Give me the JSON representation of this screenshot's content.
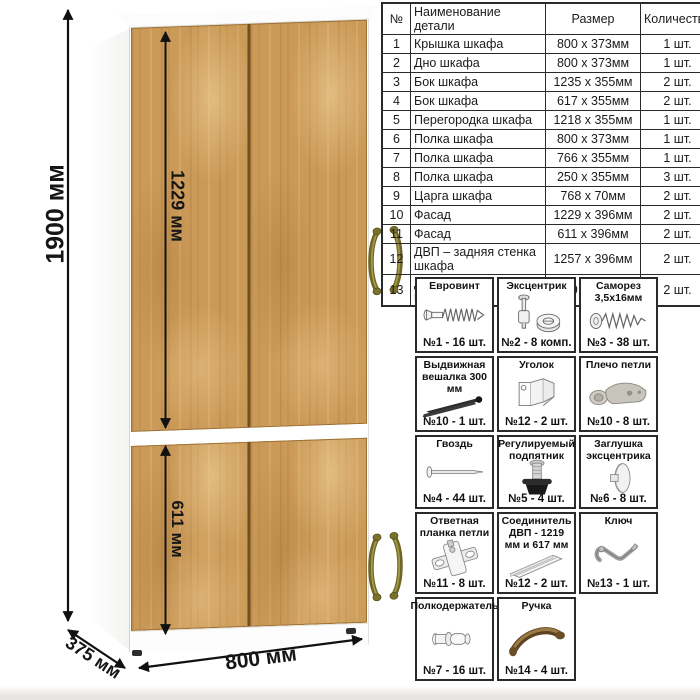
{
  "dimensions": {
    "height_label": "1900 мм",
    "upper_door_label": "1229 мм",
    "lower_door_label": "611 мм",
    "width_label": "800 мм",
    "depth_label": "375 мм"
  },
  "parts_table": {
    "headers": {
      "num": "№",
      "name": "Наименование детали",
      "size": "Размер",
      "qty": "Количество"
    },
    "rows": [
      {
        "num": "1",
        "name": "Крышка шкафа",
        "size": "800 x 373мм",
        "qty": "1 шт."
      },
      {
        "num": "2",
        "name": "Дно шкафа",
        "size": "800 x 373мм",
        "qty": "1 шт."
      },
      {
        "num": "3",
        "name": "Бок шкафа",
        "size": "1235 x 355мм",
        "qty": "2 шт."
      },
      {
        "num": "4",
        "name": "Бок шкафа",
        "size": "617 x 355мм",
        "qty": "2 шт."
      },
      {
        "num": "5",
        "name": "Перегородка шкафа",
        "size": "1218 x 355мм",
        "qty": "1 шт."
      },
      {
        "num": "6",
        "name": "Полка шкафа",
        "size": "800 x 373мм",
        "qty": "1 шт."
      },
      {
        "num": "7",
        "name": "Полка шкафа",
        "size": "766 x 355мм",
        "qty": "1 шт."
      },
      {
        "num": "8",
        "name": "Полка шкафа",
        "size": "250 x 355мм",
        "qty": "3 шт."
      },
      {
        "num": "9",
        "name": "Царга шкафа",
        "size": "768 x 70мм",
        "qty": "2 шт."
      },
      {
        "num": "10",
        "name": "Фасад",
        "size": "1229 x 396мм",
        "qty": "2 шт."
      },
      {
        "num": "11",
        "name": "Фасад",
        "size": "611 x 396мм",
        "qty": "2 шт."
      },
      {
        "num": "12",
        "name": "ДВП – задняя стенка шкафа",
        "size": "1257 x 396мм",
        "qty": "2 шт."
      },
      {
        "num": "13",
        "name": "ДВП – задняя стенка шкафа",
        "size": "639 x 396мм",
        "qty": "2 шт."
      }
    ]
  },
  "hardware": {
    "items": [
      {
        "title": "Евровинт",
        "label": "№1 - 16 шт.",
        "icon": "confirmat-screw"
      },
      {
        "title": "Эксцентрик",
        "label": "№2 - 8 комп.",
        "icon": "eccentric-cam"
      },
      {
        "title": "Саморез 3,5х16мм",
        "label": "№3 - 38 шт.",
        "icon": "self-tapping-screw"
      },
      {
        "title": "Выдвижная вешалка 300 мм",
        "label": "№10 - 1 шт.",
        "icon": "pullout-hanger"
      },
      {
        "title": "Уголок",
        "label": "№12 - 2 шт.",
        "icon": "corner-bracket"
      },
      {
        "title": "Плечо петли",
        "label": "№10 - 8 шт.",
        "icon": "hinge-arm"
      },
      {
        "title": "Гвоздь",
        "label": "№4 - 44 шт.",
        "icon": "nail"
      },
      {
        "title": "Регулируемый подпятник",
        "label": "№5 - 4 шт.",
        "icon": "adjustable-foot"
      },
      {
        "title": "Заглушка эксцентрика",
        "label": "№6 - 8 шт.",
        "icon": "cam-cover"
      },
      {
        "title": "Ответная планка петли",
        "label": "№11 - 8 шт.",
        "icon": "hinge-mounting-plate"
      },
      {
        "title": "Соединитель ДВП - 1219 мм и 617 мм",
        "label": "№12 - 2 шт.",
        "icon": "hdf-connector"
      },
      {
        "title": "Ключ",
        "label": "№13 - 1 шт.",
        "icon": "hex-key"
      },
      {
        "title": "Полкодержатель",
        "label": "№7 - 16 шт.",
        "icon": "shelf-pin"
      },
      {
        "title": "Ручка",
        "label": "№14 - 4 шт.",
        "icon": "furniture-handle"
      }
    ]
  },
  "colors": {
    "wood": "#cb9a58",
    "wood_dark": "#9d7134",
    "carcass": "#ffffff",
    "handle_brass": "#6e6526",
    "dimension_text": "#161616",
    "table_border": "#2a2a2a"
  }
}
